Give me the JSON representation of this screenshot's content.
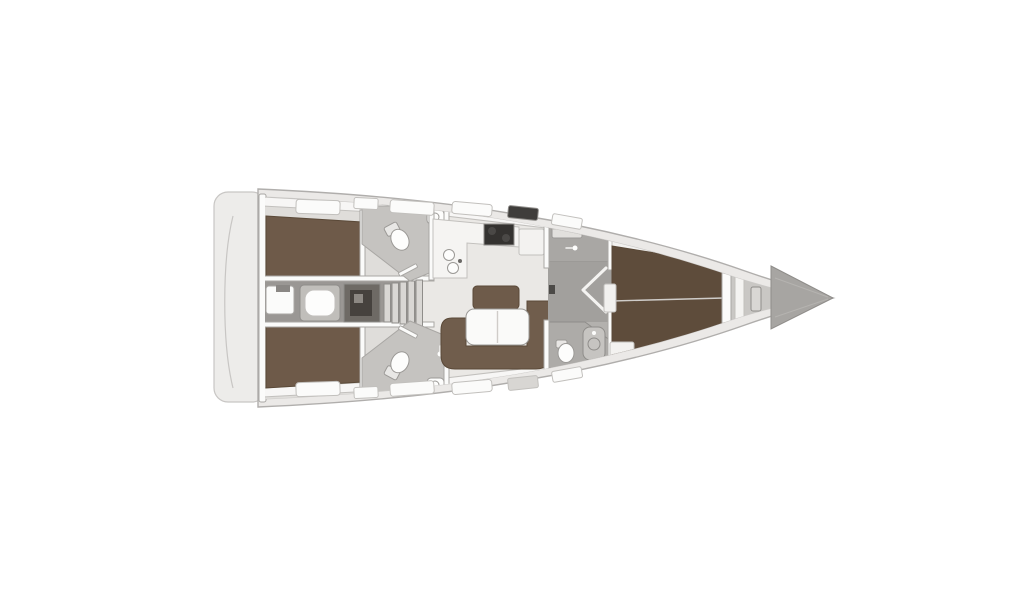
{
  "meta": {
    "description": "Top-view interior layout plan of a monohull sailing yacht, bow pointing right, no text labels in drawing",
    "background": "#ffffff"
  },
  "colors": {
    "hull_fill": "#ebe9e7",
    "deck_fill": "#f5f4f2",
    "platform_fill": "#edecea",
    "wall_fill": "#fbfbfa",
    "floor_aft": "#dfddda",
    "floor_salon": "#eae8e5",
    "floor_corridor": "#9a9794",
    "floor_head": "#c5c3c0",
    "floor_wardrobe": "#a9a7a4",
    "floor_passage": "#a2a09d",
    "floor_fwd_head": "#adaba8",
    "floor_fwd_cabin": "#b3b1ae",
    "floor_forepeak": "#c9c7c4",
    "berth_aft": "#6e5a49",
    "berth_fwd": "#5e4c3b",
    "sofa": "#705d4c",
    "bench": "#6e5b4a",
    "table": "#fafaf9",
    "counter": "#f5f4f2",
    "fixture": "#fdfdfc",
    "locker": "#f3f2f0",
    "shower_tray": "#c6c4c1",
    "engine_mid": "#6e6a65",
    "engine_dark": "#46423e",
    "step": "#d9d7d4",
    "stove": "#343230",
    "hatch_light": "#fbfbfa",
    "hatch_dark": "#3f3d3b",
    "window_band": "#514f4c",
    "bow_wedge": "#a7a5a2",
    "box_pad": "#c0beba"
  },
  "areas": {
    "list": [
      "swim-platform",
      "transom",
      "aft-cabin-top",
      "aft-cabin-bottom",
      "aft-head-top",
      "aft-head-bottom",
      "engine-compartment",
      "companionway-steps",
      "galley",
      "salon-settee",
      "salon-table",
      "wardrobe",
      "passage",
      "forward-head",
      "forward-cabin",
      "v-berth",
      "forepeak-anchor-locker",
      "bow"
    ]
  }
}
